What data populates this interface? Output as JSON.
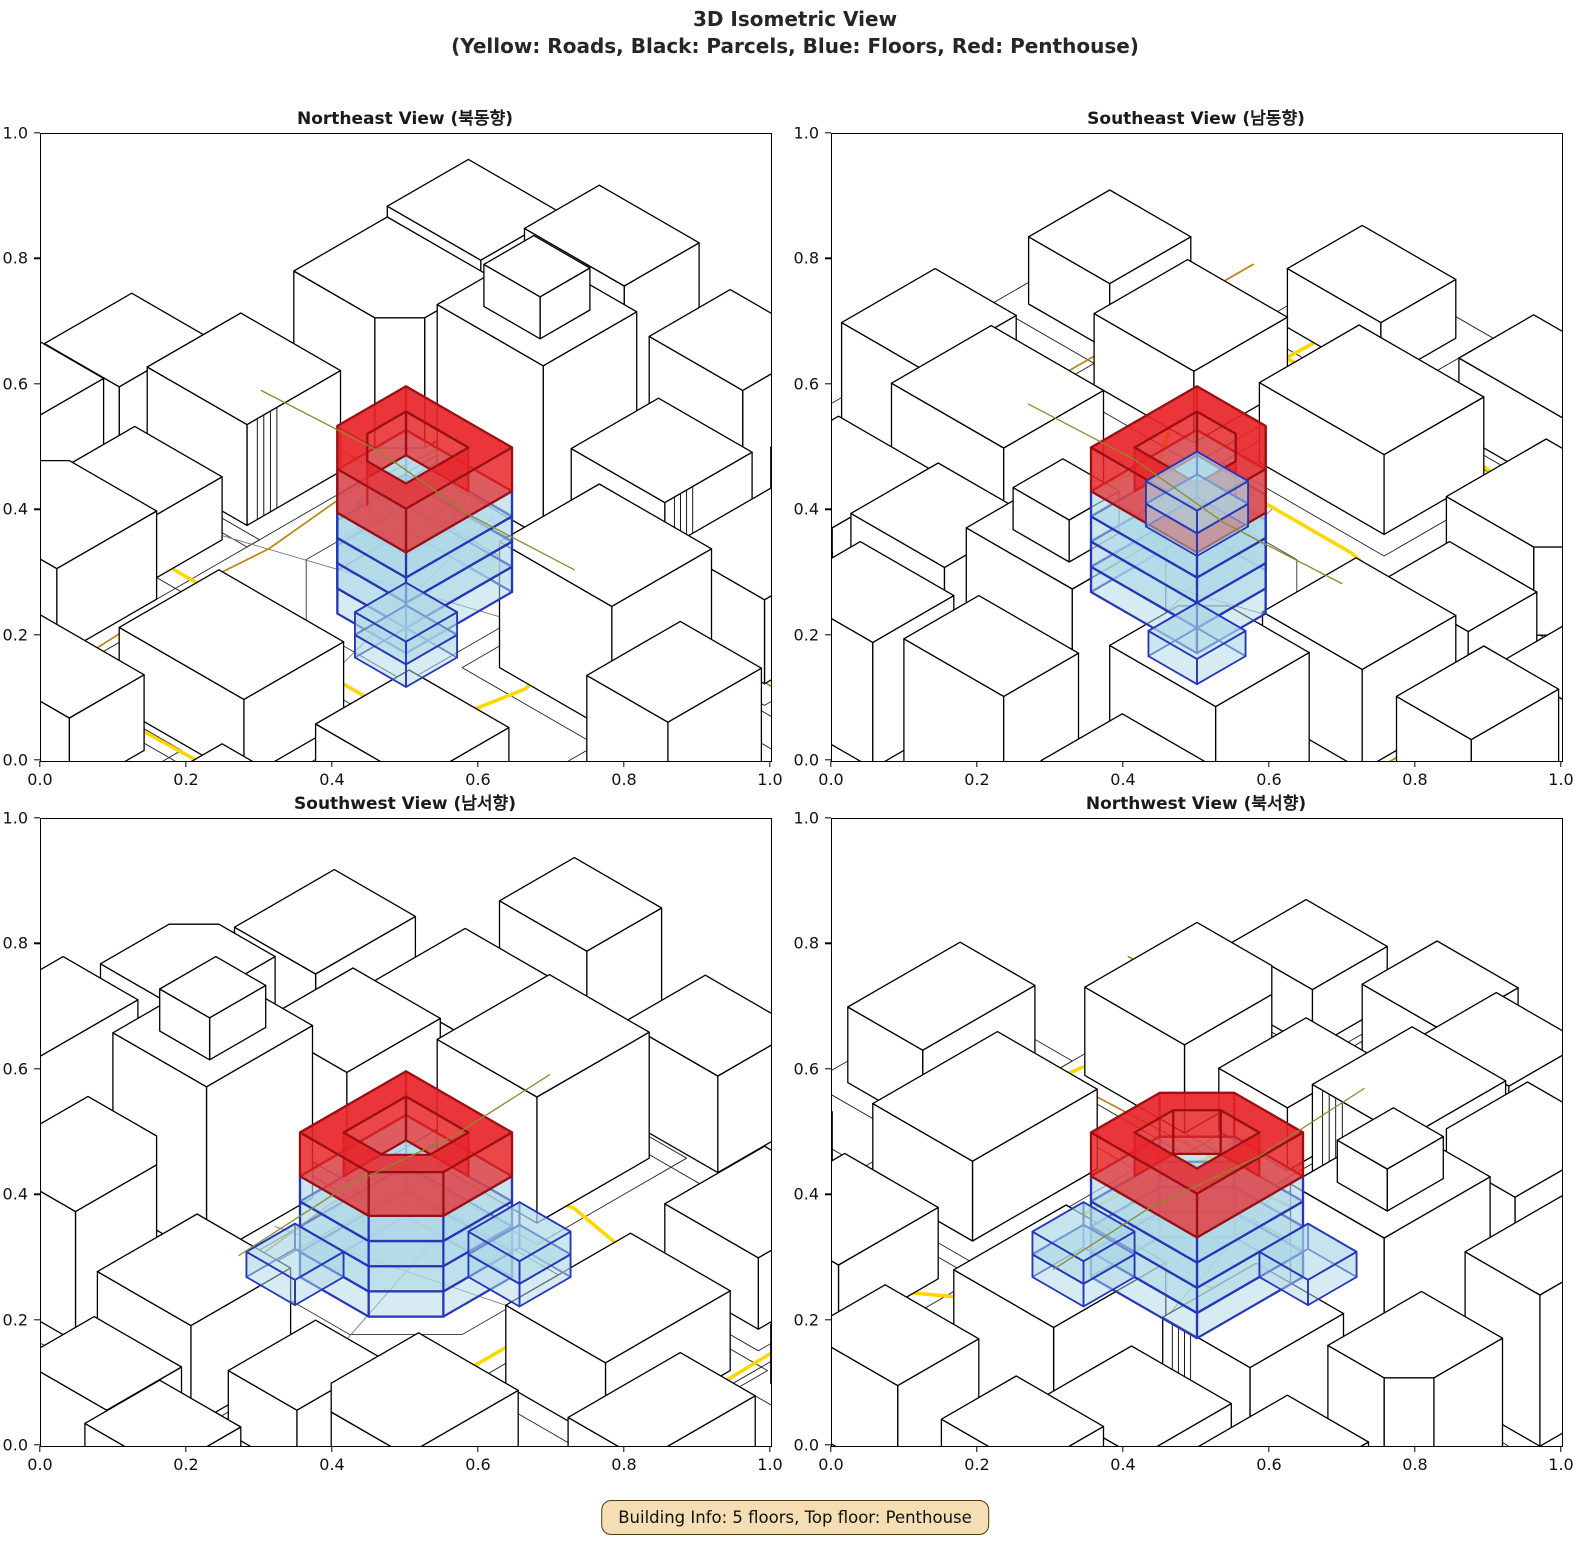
{
  "figure": {
    "title_line1": "3D Isometric View",
    "title_line2": "(Yellow: Roads, Black: Parcels, Blue: Floors, Red: Penthouse)"
  },
  "building_info": {
    "label": "Building Info: 5 floors, Top floor: Penthouse",
    "floors": 5,
    "top_floor": "Penthouse"
  },
  "chart_data": {
    "type": "isometric-3d-city",
    "title": "3D Isometric View",
    "subtitle": "(Yellow: Roads, Black: Parcels, Blue: Floors, Red: Penthouse)",
    "legend": {
      "roads": "Yellow",
      "parcels": "Black",
      "floors": "Blue",
      "penthouse": "Red"
    },
    "axes": {
      "range": [
        0.0,
        1.0
      ],
      "ticks": [
        {
          "label": "0.0",
          "value": 0.0
        },
        {
          "label": "0.2",
          "value": 0.2
        },
        {
          "label": "0.4",
          "value": 0.4
        },
        {
          "label": "0.6",
          "value": 0.6
        },
        {
          "label": "0.8",
          "value": 0.8
        },
        {
          "label": "1.0",
          "value": 1.0
        }
      ]
    },
    "views": [
      {
        "id": "northeast",
        "title": "Northeast View (북동향)",
        "rotation_deg": 0
      },
      {
        "id": "southeast",
        "title": "Southeast View (남동향)",
        "rotation_deg": 180
      },
      {
        "id": "southwest",
        "title": "Southwest View (남서향)",
        "rotation_deg": 270
      },
      {
        "id": "northwest",
        "title": "Northwest View (북서향)",
        "rotation_deg": 90
      }
    ],
    "colors": {
      "road_major": "#FFD700",
      "road_minor": "#B8860B",
      "road_overlay": "#8a8a2e",
      "parcel": "#222222",
      "parcel_minor": "#777777",
      "building_fill": "#ffffff",
      "building_edge": "#000000",
      "floor_fill": "#add8e6",
      "floor_edge": "#2736b6",
      "penthouse_fill": "#e82528",
      "penthouse_edge": "#9c0f13"
    },
    "projection": {
      "k": 72,
      "kz": 84,
      "cos": 0.866,
      "sin": 0.5,
      "cy": 458
    },
    "scene": {
      "buildings": [
        {
          "x": -2.7,
          "y": -2.5,
          "w": 1.7,
          "d": 1.5,
          "h": 1.55,
          "ch": 2
        },
        {
          "x": -0.5,
          "y": -2.6,
          "w": 1.7,
          "d": 1.5,
          "h": 2.05,
          "tier": {
            "w": 0.9,
            "d": 0.8,
            "h": 0.5
          }
        },
        {
          "x": 1.6,
          "y": -2.5,
          "w": 1.5,
          "d": 1.4,
          "h": 1.3,
          "striped": true
        },
        {
          "x": 3.4,
          "y": -2.4,
          "w": 1.5,
          "d": 1.6,
          "h": 1.0
        },
        {
          "x": -3.3,
          "y": -4.4,
          "w": 1.5,
          "d": 1.3,
          "h": 1.25
        },
        {
          "x": -1.2,
          "y": -4.5,
          "w": 1.6,
          "d": 1.2,
          "h": 1.8
        },
        {
          "x": 0.9,
          "y": -4.4,
          "w": 1.5,
          "d": 1.3,
          "h": 1.5,
          "ch": 1
        },
        {
          "x": 3.0,
          "y": -4.3,
          "w": 1.6,
          "d": 1.3,
          "h": 1.1
        },
        {
          "x": -3.0,
          "y": -0.4,
          "w": 1.6,
          "d": 1.5,
          "h": 1.2,
          "striped": true
        },
        {
          "x": -4.7,
          "y": -0.2,
          "w": 1.2,
          "d": 1.4,
          "h": 0.9
        },
        {
          "x": 2.7,
          "y": -0.5,
          "w": 1.8,
          "d": 1.6,
          "h": 1.5
        },
        {
          "x": 4.6,
          "y": 0.3,
          "w": 1.3,
          "d": 1.5,
          "h": 1.15
        },
        {
          "x": -2.9,
          "y": 1.3,
          "w": 1.4,
          "d": 1.1,
          "h": 0.75
        },
        {
          "x": -2.8,
          "y": 2.9,
          "w": 1.8,
          "d": 1.6,
          "h": 1.05,
          "ch": 0
        },
        {
          "x": -4.7,
          "y": 2.9,
          "w": 1.2,
          "d": 1.3,
          "h": 0.7
        },
        {
          "x": 0.3,
          "y": 3.1,
          "w": 2.0,
          "d": 1.6,
          "h": 0.95
        },
        {
          "x": 2.9,
          "y": 2.8,
          "w": 1.6,
          "d": 1.5,
          "h": 0.85,
          "striped": true
        },
        {
          "x": 4.7,
          "y": 3.3,
          "w": 1.3,
          "d": 1.3,
          "h": 0.8
        },
        {
          "x": -0.8,
          "y": 4.9,
          "w": 1.8,
          "d": 1.2,
          "h": 0.9
        },
        {
          "x": 2.2,
          "y": 5.0,
          "w": 1.5,
          "d": 1.2,
          "h": 0.7
        },
        {
          "x": 5.0,
          "y": -2.2,
          "w": 1.2,
          "d": 1.4,
          "h": 1.35
        },
        {
          "x": -5.0,
          "y": 1.1,
          "w": 1.2,
          "d": 1.3,
          "h": 0.85
        }
      ],
      "roads_major": [
        [
          [
            -5,
            1.55
          ],
          [
            -1.8,
            1.55
          ],
          [
            -0.7,
            1.78
          ],
          [
            1.1,
            1.78
          ],
          [
            2.1,
            1.5
          ],
          [
            2.6,
            2.2
          ],
          [
            2.5,
            5
          ]
        ],
        [
          [
            2.3,
            -5
          ],
          [
            2.3,
            -2.2
          ],
          [
            2.15,
            -0.9
          ],
          [
            2.3,
            0.4
          ],
          [
            2.1,
            1.5
          ]
        ],
        [
          [
            -5,
            3.9
          ],
          [
            -2.2,
            3.8
          ],
          [
            -0.5,
            4.05
          ],
          [
            5,
            3.9
          ]
        ]
      ],
      "roads_minor": [
        [
          [
            -5,
            -1.45
          ],
          [
            -1,
            -1.45
          ],
          [
            0.4,
            -1.62
          ],
          [
            5,
            -1.62
          ]
        ],
        [
          [
            -1.7,
            -5
          ],
          [
            -1.7,
            -2.4
          ],
          [
            -1.85,
            -1
          ],
          [
            -1.7,
            0.5
          ],
          [
            -1.78,
            1.55
          ],
          [
            -1.62,
            5
          ]
        ],
        [
          [
            -5,
            -3.35
          ],
          [
            5,
            -3.35
          ]
        ],
        [
          [
            -3.9,
            -5
          ],
          [
            -3.9,
            5
          ]
        ],
        [
          [
            4.1,
            -5
          ],
          [
            4.1,
            5
          ]
        ]
      ],
      "road_overlay": [
        [
          -2.5,
          -0.18
        ],
        [
          -0.7,
          -0.28
        ],
        [
          0.9,
          -0.12
        ],
        [
          2.5,
          -0.2
        ]
      ],
      "parcel_pad": 0.3,
      "central_parcel": [
        [
          -1.25,
          -1.25
        ],
        [
          1.25,
          -1.25
        ],
        [
          1.25,
          1.25
        ],
        [
          -0.35,
          1.25
        ],
        [
          -1.25,
          0.35
        ]
      ],
      "parcel_lines": [
        [
          [
            -3.2,
            1.0
          ],
          [
            2.6,
            -0.9
          ]
        ],
        [
          [
            -0.35,
            -1.75
          ],
          [
            0.55,
            1.75
          ]
        ]
      ],
      "central_building": {
        "footprint": [
          [
            -0.85,
            -0.85
          ],
          [
            0.85,
            -0.85
          ],
          [
            0.85,
            0.85
          ],
          [
            -0.25,
            0.85
          ],
          [
            -0.85,
            0.25
          ]
        ],
        "penthouse_inner": [
          [
            -0.5,
            -0.5
          ],
          [
            0.5,
            -0.5
          ],
          [
            0.5,
            0.5
          ],
          [
            -0.12,
            0.5
          ],
          [
            -0.5,
            0.12
          ]
        ],
        "num_regular_floors": 4,
        "floor_height": 0.3,
        "penthouse_base": 1.2,
        "penthouse_top": 1.72,
        "annex_near": {
          "rect": [
            0.5,
            0.5,
            1.32,
            1.32
          ],
          "floors": 2,
          "floor_height": 0.27
        },
        "annex_far": {
          "rect": [
            -1.28,
            -1.28,
            -0.5,
            -0.5
          ],
          "floors": 1,
          "floor_height": 0.3
        }
      }
    }
  },
  "layout_note": "static matplotlib-style figure"
}
